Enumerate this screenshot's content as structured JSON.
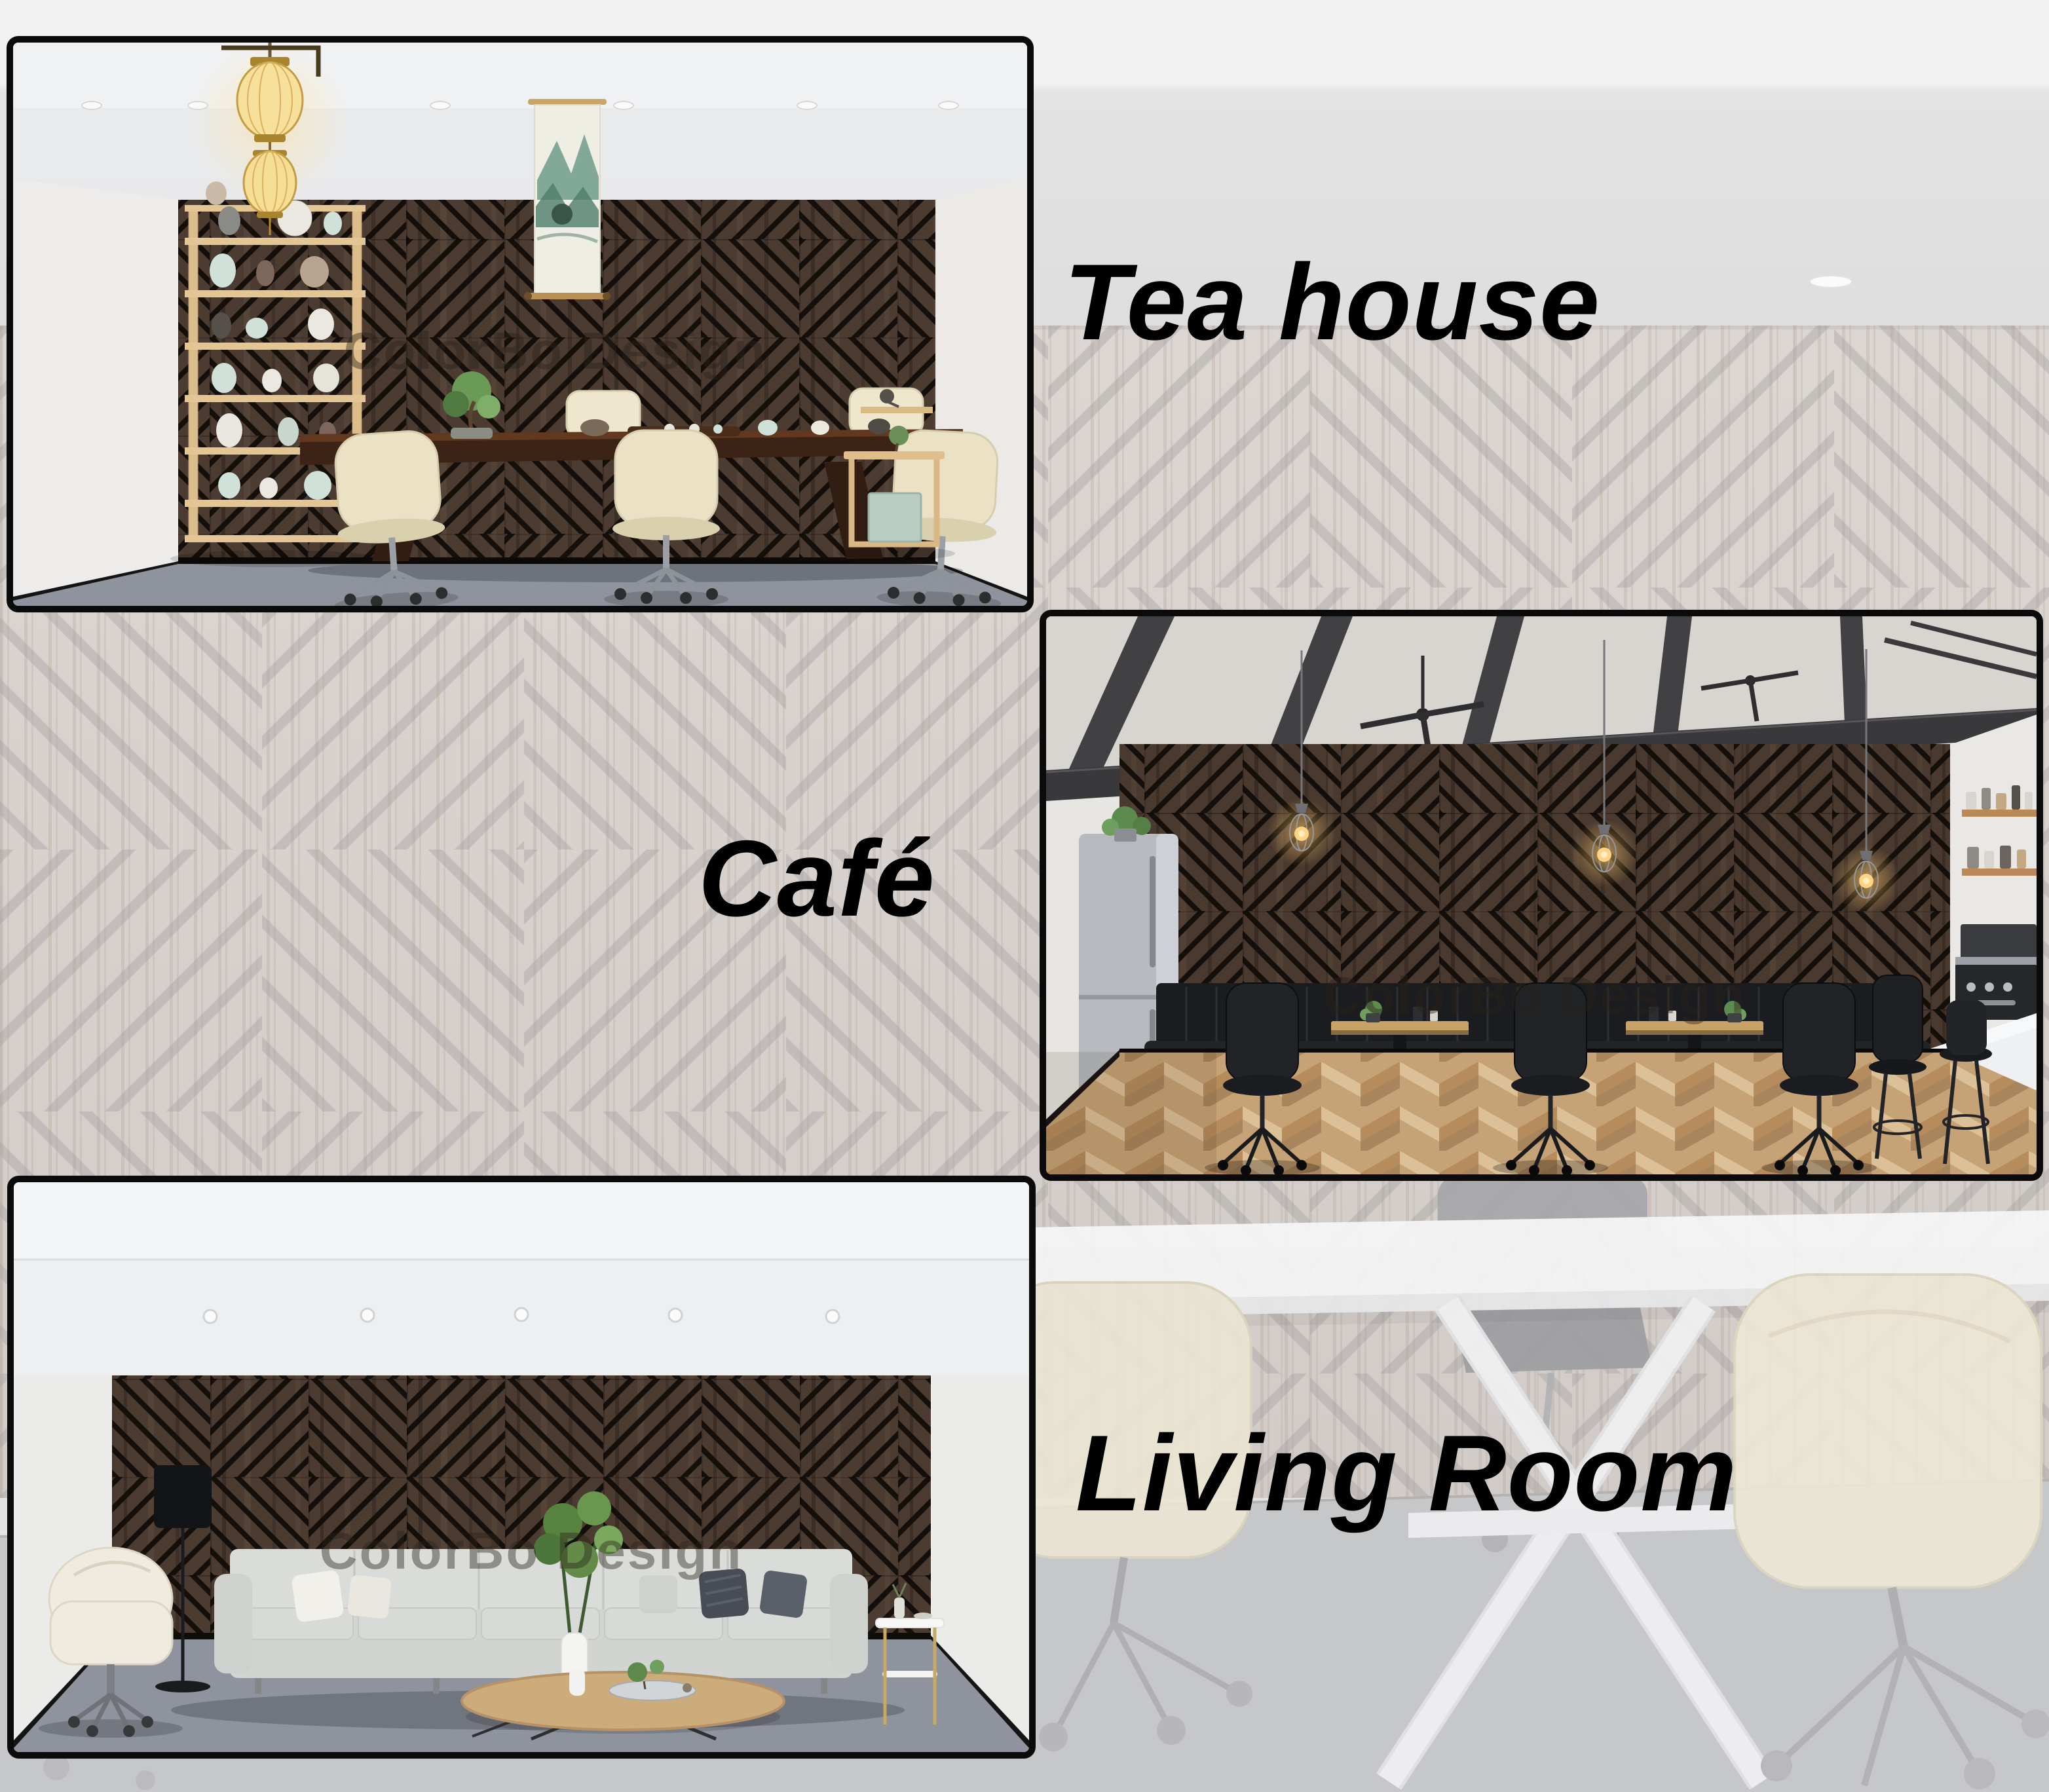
{
  "image_type": "interior product collage",
  "brand": {
    "watermark": "ColorBo Design"
  },
  "labels": {
    "tea_house": "Tea house",
    "cafe": "Café",
    "living_room": "Living Room"
  },
  "scenes": [
    {
      "id": "tea-house",
      "label": "Tea house",
      "watermark": "ColorBo Design",
      "alt": "Tea room with dark geometric slat acoustic wood wall panels, long dark wood tea table with tea set and bonsai, cream swivel chairs, golden lanterns, ceramic display shelf and landscape scroll painting on gray carpet"
    },
    {
      "id": "cafe",
      "label": "Café",
      "watermark": "ColorBo Design",
      "alt": "Industrial café with dark geometric acoustic wood wall panels, black beam ceiling with fans, Edison pendant lights, stainless fridge, black leather banquette, wooden bistro tables, black chairs, marble coffee counter and herringbone wood floor"
    },
    {
      "id": "living-room",
      "label": "Living Room",
      "watermark": "ColorBo Design",
      "alt": "Living room with dark geometric acoustic wood wall panels, light gray four-seat sofa with pillows, cream swivel armchair, black floor lamp, green plants, oval wooden coffee table and white side table on gray carpet"
    }
  ],
  "background": {
    "description": "washed-out render of the same acoustic wall panels with a white meeting table and cream chairs",
    "stripe_color": "#a5a1a0",
    "wall_color": "#d9d3cf",
    "carpet_color": "#c6c7c9"
  },
  "colors": {
    "label_text": "#000000",
    "photo_border": "#0b0b0b",
    "panel_wood": "#4c3b30",
    "panel_groove": "#140f0b",
    "scene_carpet": "#8e939e",
    "ceiling_light_gray": "#f1f1f2"
  }
}
